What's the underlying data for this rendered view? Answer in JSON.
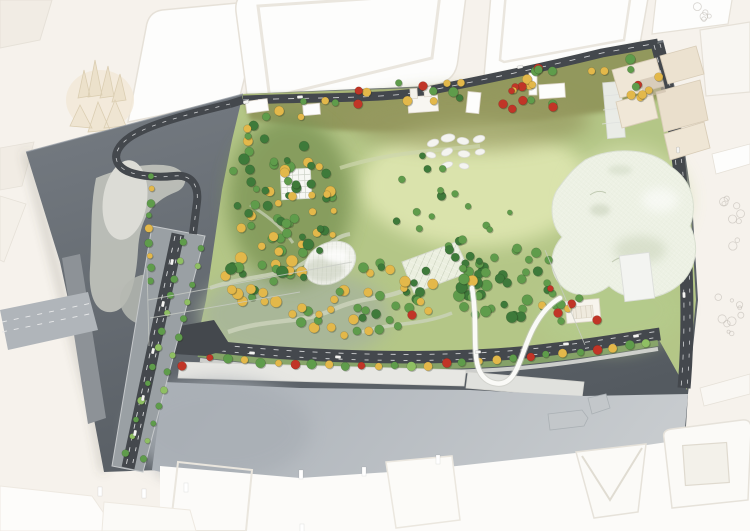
{
  "palette": {
    "table": "#f6f2ec",
    "white": "#fdfdfc",
    "white_soft": "#f1ece4",
    "white_edge": "#e6e1d8",
    "cream": "#f2e9d8",
    "cream_edge": "#dbceb2",
    "beige": "#efe6d6",
    "beige_shadow": "#d9cdb8",
    "board_dark": "#5b6167",
    "board_light": "#c2c4bd",
    "asphalt": "#44484d",
    "lane": "#e8e9ea",
    "quay": "#e7e7e3",
    "river": "#b6bcc2",
    "park_base": "#b4c687",
    "park_olive": "#8d9156",
    "park_pale": "#dde5af",
    "park_gray": "#a8b69a",
    "forest_floor": "#7c9454",
    "path": "#cbd2ba",
    "verge": "#8aa868",
    "tree_dark": "#3e7a3a",
    "tree_mid": "#5f9c4b",
    "tree_light": "#8fbf63",
    "tree_yellow": "#e3b84a",
    "tree_red": "#c13527",
    "canopy": "#edf1e4",
    "canopy_shade": "#c9d3b9",
    "dome": "#f1f2ec",
    "ribbon": "#fafaf7",
    "car": "#f4f4f2",
    "boat": "#c3c7ca",
    "sketch": "#b9b5ad",
    "wire": "#c9ccc6"
  },
  "scene": {
    "tree_clusters": [
      {
        "name": "forest-main",
        "cx": 287,
        "cy": 195,
        "rx": 52,
        "ry": 85,
        "rot": -18,
        "count": 66,
        "rmin": 3,
        "rmax": 5.5,
        "seed": 11,
        "mix": {
          "dark": 0.4,
          "mid": 0.35,
          "yellow": 0.25
        }
      },
      {
        "name": "forest-west-yellow",
        "cx": 258,
        "cy": 272,
        "rx": 36,
        "ry": 50,
        "rot": -10,
        "count": 26,
        "rmin": 3.5,
        "rmax": 6,
        "seed": 12,
        "mix": {
          "yellow": 0.6,
          "mid": 0.25,
          "dark": 0.15
        }
      },
      {
        "name": "center-mix",
        "cx": 385,
        "cy": 296,
        "rx": 55,
        "ry": 36,
        "rot": -6,
        "count": 30,
        "rmin": 3.5,
        "rmax": 5.5,
        "seed": 13,
        "mix": {
          "yellow": 0.42,
          "mid": 0.38,
          "dark": 0.2
        }
      },
      {
        "name": "east-green",
        "cx": 508,
        "cy": 286,
        "rx": 56,
        "ry": 40,
        "rot": -8,
        "count": 44,
        "rmin": 3.5,
        "rmax": 6,
        "seed": 14,
        "mix": {
          "dark": 0.45,
          "mid": 0.5,
          "yellow": 0.05
        }
      },
      {
        "name": "mid-sparse",
        "cx": 418,
        "cy": 195,
        "rx": 32,
        "ry": 42,
        "rot": 0,
        "count": 9,
        "rmin": 3,
        "rmax": 4.5,
        "seed": 15,
        "mix": {
          "mid": 0.8,
          "dark": 0.2
        }
      },
      {
        "name": "top-band",
        "cx": 450,
        "cy": 88,
        "rx": 195,
        "ry": 13,
        "rot": -8,
        "count": 24,
        "rmin": 3,
        "rmax": 5,
        "seed": 16,
        "mix": {
          "yellow": 0.45,
          "mid": 0.3,
          "dark": 0.1,
          "red": 0.15
        }
      },
      {
        "name": "ne-corner",
        "cx": 636,
        "cy": 80,
        "rx": 26,
        "ry": 20,
        "rot": -10,
        "count": 8,
        "rmin": 3,
        "rmax": 5,
        "seed": 17,
        "mix": {
          "yellow": 0.55,
          "mid": 0.3,
          "red": 0.15
        }
      },
      {
        "name": "canopy-south",
        "cx": 560,
        "cy": 302,
        "rx": 24,
        "ry": 20,
        "rot": 0,
        "count": 8,
        "rmin": 3,
        "rmax": 4.5,
        "seed": 18,
        "mix": {
          "mid": 0.5,
          "yellow": 0.3,
          "red": 0.2
        }
      },
      {
        "name": "lawn-sparse",
        "cx": 468,
        "cy": 205,
        "rx": 48,
        "ry": 28,
        "rot": 0,
        "count": 6,
        "rmin": 2.5,
        "rmax": 4,
        "seed": 19,
        "mix": {
          "mid": 0.9,
          "dark": 0.1
        }
      },
      {
        "name": "top-mid",
        "cx": 530,
        "cy": 96,
        "rx": 38,
        "ry": 14,
        "rot": -8,
        "count": 9,
        "rmin": 3,
        "rmax": 4.5,
        "seed": 20,
        "mix": {
          "yellow": 0.5,
          "mid": 0.3,
          "red": 0.2
        }
      },
      {
        "name": "dome-south-yellow",
        "cx": 330,
        "cy": 318,
        "rx": 40,
        "ry": 22,
        "rot": -4,
        "count": 14,
        "rmin": 3.5,
        "rmax": 5.5,
        "seed": 21,
        "mix": {
          "yellow": 0.55,
          "mid": 0.45
        }
      },
      {
        "name": "trellis-east",
        "cx": 465,
        "cy": 255,
        "rx": 20,
        "ry": 16,
        "rot": 0,
        "count": 10,
        "rmin": 3,
        "rmax": 4.5,
        "seed": 22,
        "mix": {
          "mid": 0.7,
          "dark": 0.3
        }
      }
    ],
    "tree_rows": [
      {
        "name": "embankment-row",
        "pts": [
          [
            202,
            358
          ],
          [
            300,
            365
          ],
          [
            420,
            366
          ],
          [
            520,
            358
          ],
          [
            600,
            349
          ],
          [
            655,
            342
          ]
        ],
        "count": 27,
        "r": 4,
        "seed": 31,
        "colors": [
          "red",
          "mid",
          "yellow",
          "mid",
          "yellow",
          "red",
          "mid",
          "yellow",
          "mid",
          "red",
          "yellow",
          "mid",
          "light",
          "yellow",
          "red",
          "mid",
          "yellow",
          "yellow",
          "mid",
          "red",
          "mid",
          "yellow",
          "mid",
          "red",
          "yellow",
          "mid",
          "light"
        ]
      },
      {
        "name": "bridge-row-left",
        "pts": [
          [
            186,
            234
          ],
          [
            157,
            350
          ],
          [
            124,
            462
          ]
        ],
        "count": 13,
        "r": 3.2,
        "seed": 32,
        "colors": [
          "mid",
          "light",
          "mid",
          "mid",
          "light",
          "mid",
          "light",
          "mid",
          "mid",
          "light",
          "mid",
          "light",
          "mid"
        ]
      },
      {
        "name": "bridge-row-right",
        "pts": [
          [
            204,
            240
          ],
          [
            173,
            355
          ],
          [
            140,
            468
          ]
        ],
        "count": 13,
        "r": 3.2,
        "seed": 33,
        "colors": [
          "mid",
          "light",
          "mid",
          "light",
          "mid",
          "mid",
          "light",
          "mid",
          "light",
          "mid",
          "mid",
          "light",
          "mid"
        ]
      },
      {
        "name": "loop-row",
        "pts": [
          [
            152,
            170
          ],
          [
            148,
            228
          ],
          [
            152,
            288
          ]
        ],
        "count": 9,
        "r": 3.5,
        "seed": 34,
        "colors": [
          "mid",
          "yellow",
          "mid",
          "mid",
          "yellow",
          "mid",
          "yellow",
          "mid",
          "mid"
        ]
      }
    ],
    "single_trees": [
      [
        423,
        86,
        "red"
      ],
      [
        503,
        104,
        "red"
      ],
      [
        553,
        107,
        "red"
      ],
      [
        358,
        104,
        "red"
      ],
      [
        558,
        313,
        "red"
      ],
      [
        597,
        320,
        "red"
      ],
      [
        412,
        315,
        "red"
      ],
      [
        182,
        366,
        "red"
      ]
    ],
    "cars": [
      [
        172,
        262,
        102
      ],
      [
        163,
        304,
        102
      ],
      [
        153,
        351,
        102
      ],
      [
        143,
        398,
        102
      ],
      [
        135,
        433,
        102
      ],
      [
        252,
        353,
        4
      ],
      [
        338,
        357,
        2
      ],
      [
        478,
        352,
        -3
      ],
      [
        566,
        344,
        -5
      ],
      [
        636,
        336,
        -6
      ],
      [
        300,
        97,
        -3
      ],
      [
        520,
        67,
        -13
      ],
      [
        246,
        102,
        -14
      ],
      [
        678,
        150,
        86
      ],
      [
        684,
        295,
        88
      ]
    ],
    "pond_stones": [
      [
        433,
        143,
        6,
        3.5,
        -20
      ],
      [
        448,
        138,
        7,
        4,
        -8
      ],
      [
        463,
        141,
        6,
        3.5,
        10
      ],
      [
        479,
        139,
        6,
        3.5,
        -15
      ],
      [
        431,
        155,
        5,
        3,
        15
      ],
      [
        447,
        152,
        6,
        3.5,
        -25
      ],
      [
        464,
        154,
        6,
        3.5,
        5
      ],
      [
        480,
        152,
        5,
        3,
        -10
      ],
      [
        447,
        165,
        6,
        3,
        -18
      ],
      [
        464,
        166,
        5,
        3,
        8
      ]
    ],
    "sketch_clusters": [
      [
        733,
        220,
        13,
        26,
        9,
        41
      ],
      [
        727,
        316,
        15,
        26,
        10,
        42
      ],
      [
        704,
        14,
        10,
        12,
        5,
        43
      ]
    ],
    "bottom_posts": [
      [
        98,
        487
      ],
      [
        142,
        489
      ],
      [
        184,
        483
      ],
      [
        299,
        470
      ],
      [
        362,
        467
      ],
      [
        436,
        455
      ],
      [
        300,
        524
      ]
    ],
    "wires": [
      [
        148,
        300,
        352,
        262
      ],
      [
        150,
        318,
        300,
        292
      ],
      [
        545,
        250,
        585,
        345
      ],
      [
        147,
        268,
        149,
        346
      ]
    ]
  }
}
